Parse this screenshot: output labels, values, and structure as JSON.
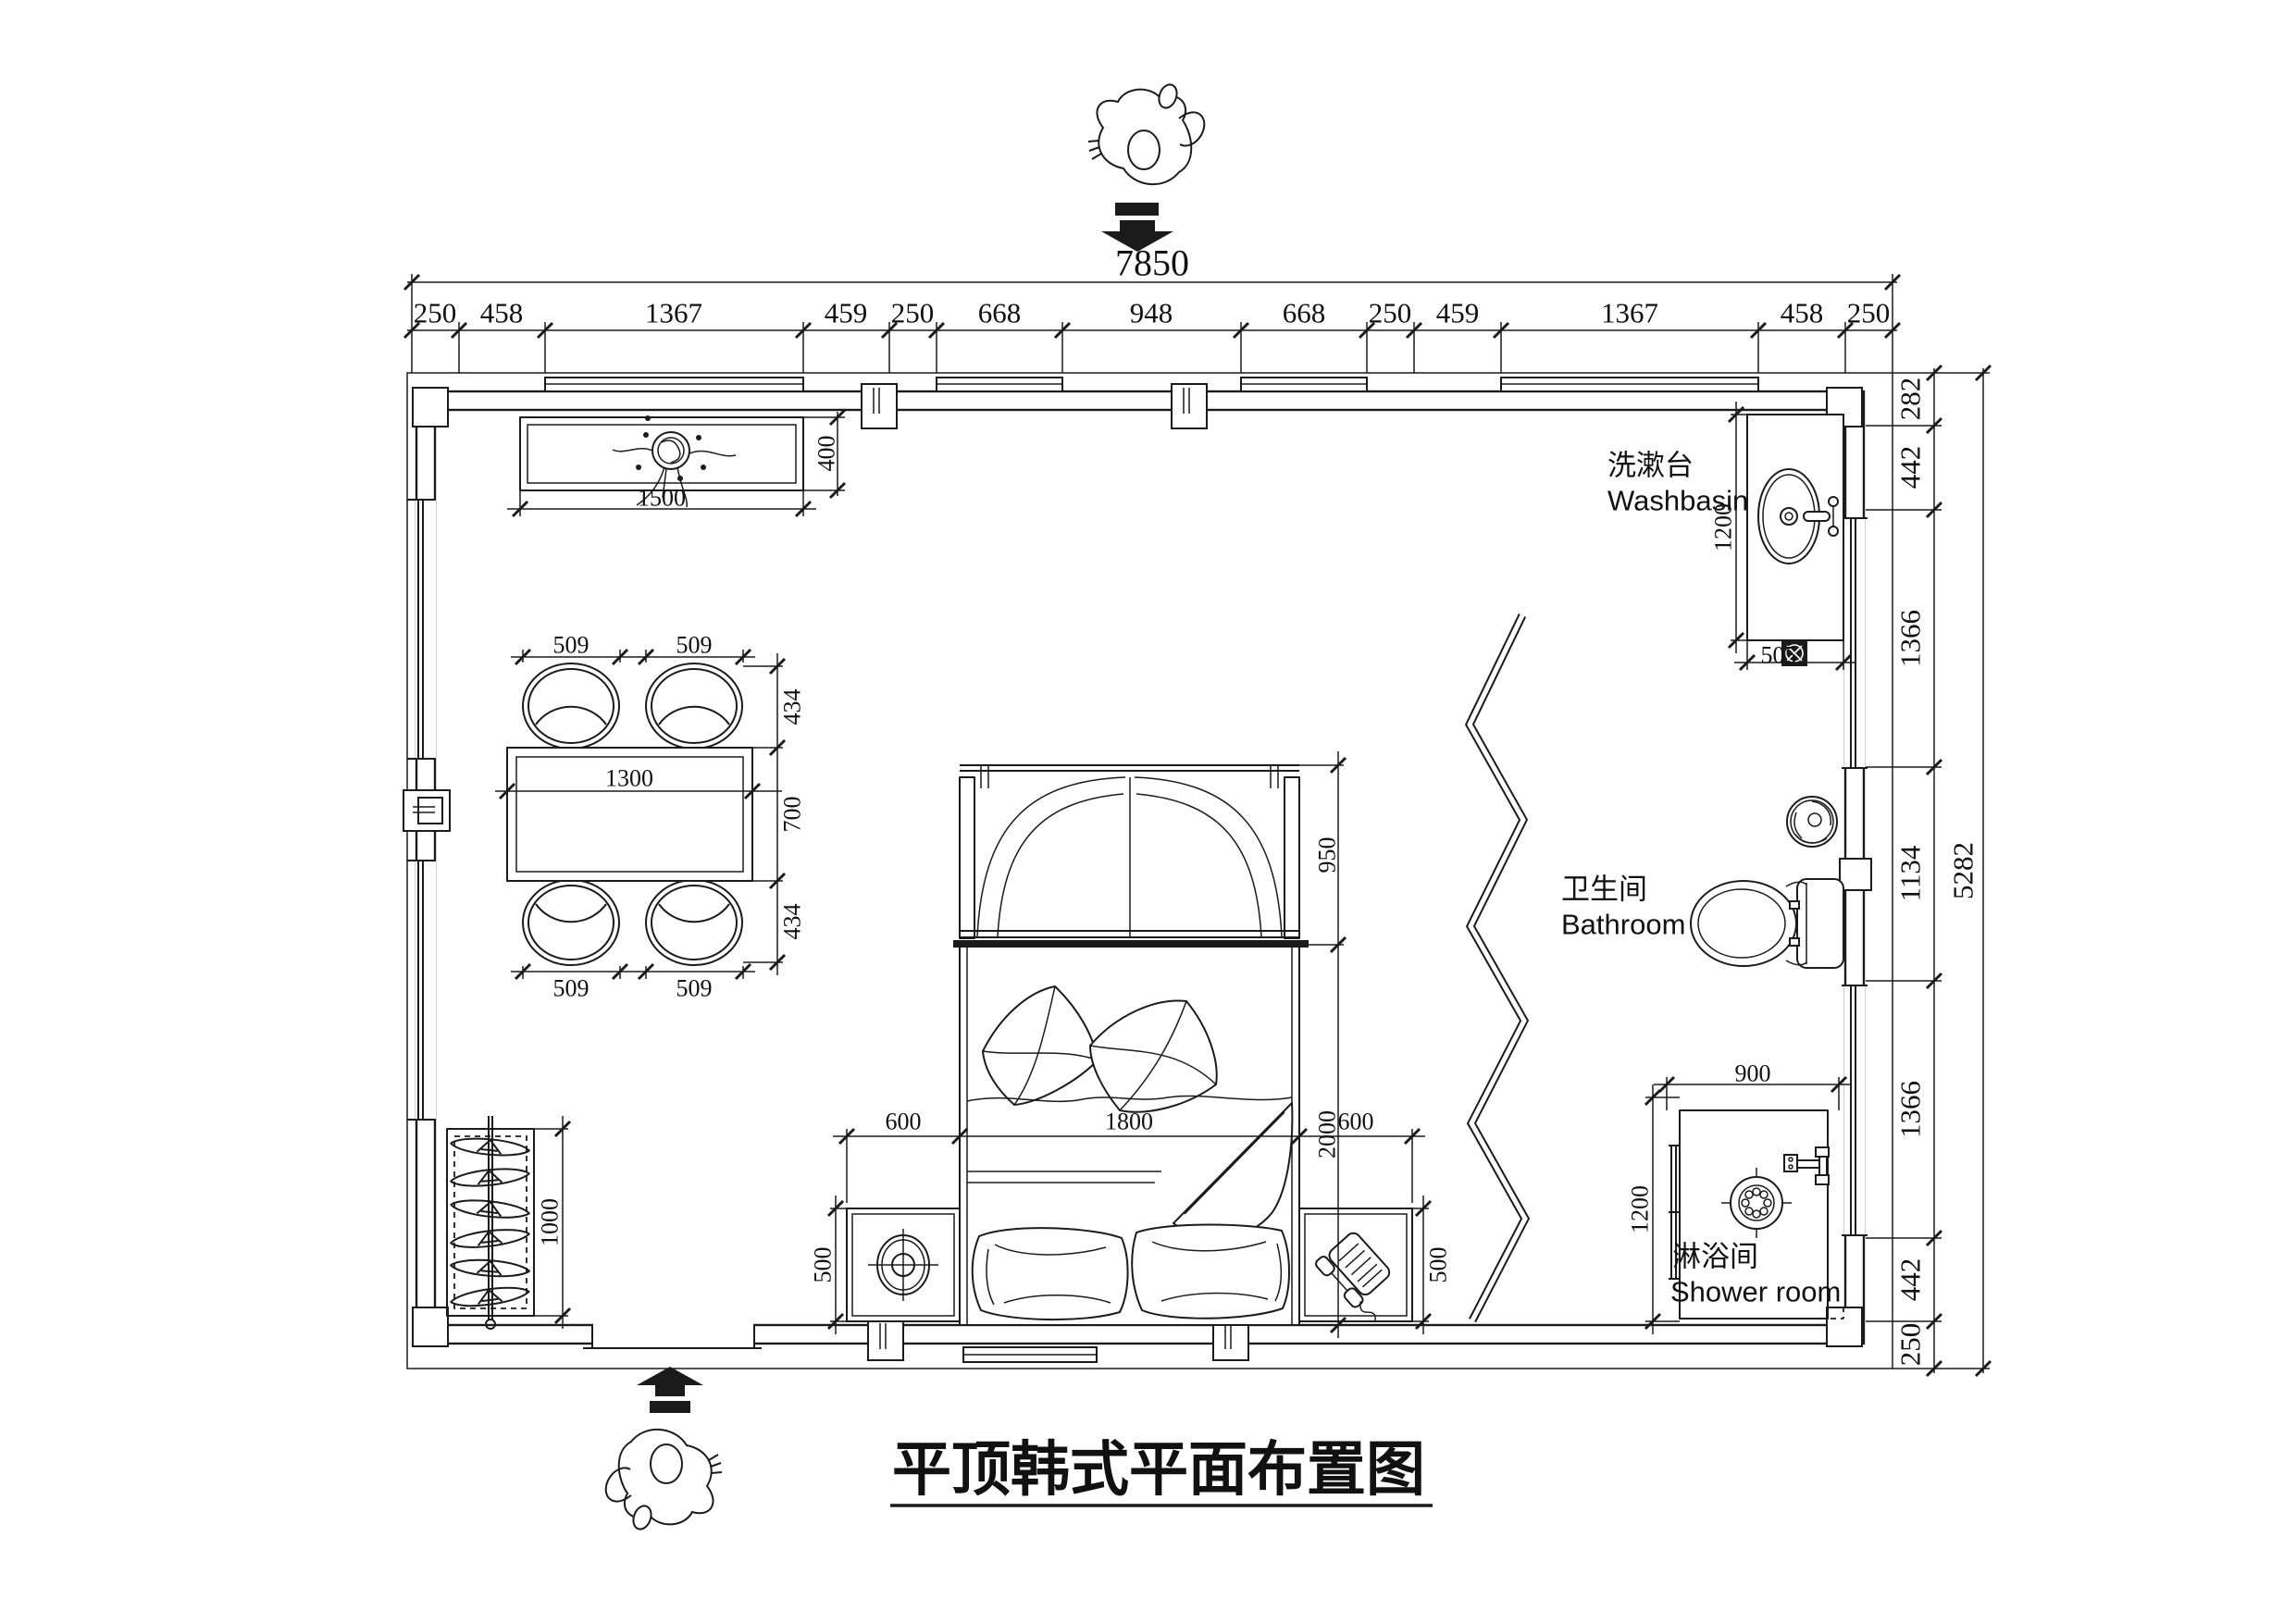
{
  "title": {
    "text": "平顶韩式平面布置图"
  },
  "dims": {
    "top_total": "7850",
    "top_chain": [
      "250",
      "458",
      "1367",
      "459",
      "250",
      "668",
      "948",
      "668",
      "250",
      "459",
      "1367",
      "458",
      "250"
    ],
    "right_chain": [
      "282",
      "442",
      "1366",
      "1134",
      "1366",
      "442",
      "250"
    ],
    "right_total": "5282"
  },
  "cabinet": {
    "width": "1500",
    "depth": "400"
  },
  "dining": {
    "table_width": "1300",
    "chair_widths": [
      "509",
      "509",
      "509",
      "509"
    ],
    "side_dims": [
      "434",
      "700",
      "434"
    ]
  },
  "rack": {
    "length": "1000"
  },
  "bed_zone": {
    "left_stand_width": "600",
    "bed_width": "1800",
    "right_stand_width": "600",
    "bed_length": "2000",
    "wardrobe_depth": "950",
    "left_stand_depth": "500",
    "right_stand_depth": "500"
  },
  "washbasin": {
    "label_zh": "洗漱台",
    "label_en": "Washbasin",
    "counter_length": "1200",
    "counter_width": "505"
  },
  "bathroom": {
    "label_zh": "卫生间",
    "label_en": "Bathroom"
  },
  "shower": {
    "label_zh": "淋浴间",
    "label_en": "Shower room",
    "width": "900",
    "depth": "1200"
  },
  "colors": {
    "line": "#1b1b1b",
    "background": "#ffffff"
  }
}
